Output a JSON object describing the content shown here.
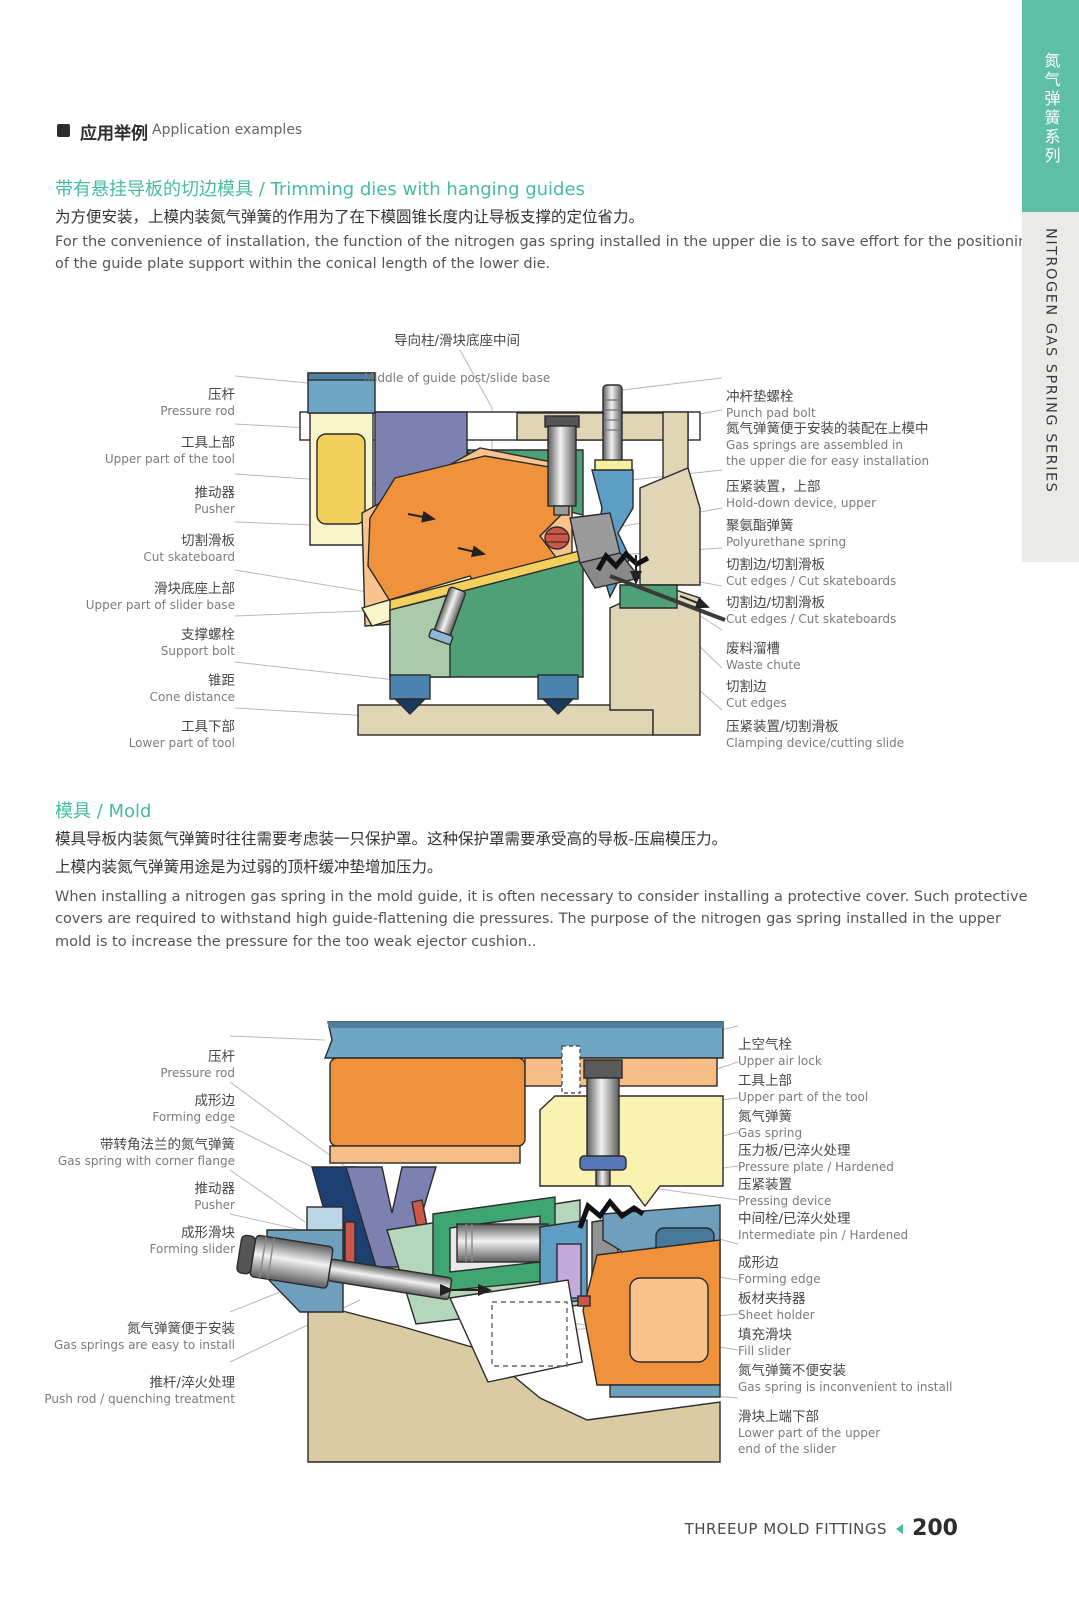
{
  "header": {
    "title_zh": "应用举例",
    "title_en": "Application examples",
    "bullet_icon": "filled-square"
  },
  "sidebar": {
    "title_zh": "氮气弹簧系列",
    "title_en": "NITROGEN GAS SPRING SERIES",
    "teal_color": "#5ebea6",
    "gray_color": "#eaeae8"
  },
  "section1": {
    "heading": "带有悬挂导板的切边模具 / Trimming dies with hanging guides",
    "body_zh": "为方便安装，上模内装氮气弹簧的作用为了在下模圆锥长度内让导板支撑的定位省力。",
    "body_en": "For the convenience of installation, the function of the nitrogen gas spring installed in the upper die is to save effort for the positioning\nof the guide plate support within the conical length of the lower die."
  },
  "diagram1": {
    "top_label": {
      "zh": "导向柱/滑块底座中间",
      "en": "Middle of guide post/slide base"
    },
    "left_labels": [
      {
        "zh": "压杆",
        "en": "Pressure rod"
      },
      {
        "zh": "工具上部",
        "en": "Upper part of the tool"
      },
      {
        "zh": "推动器",
        "en": "Pusher"
      },
      {
        "zh": "切割滑板",
        "en": "Cut skateboard"
      },
      {
        "zh": "滑块底座上部",
        "en": "Upper part of slider base"
      },
      {
        "zh": "支撑螺栓",
        "en": "Support bolt"
      },
      {
        "zh": "锥距",
        "en": "Cone distance"
      },
      {
        "zh": "工具下部",
        "en": "Lower part of tool"
      }
    ],
    "right_labels": [
      {
        "zh": "冲杆垫螺栓",
        "en": "Punch pad bolt"
      },
      {
        "zh": "氮气弹簧便于安装的装配在上模中",
        "en": "Gas springs are assembled in\nthe upper die for easy installation"
      },
      {
        "zh": "压紧装置，上部",
        "en": "Hold-down device, upper"
      },
      {
        "zh": "聚氨酯弹簧",
        "en": "Polyurethane spring"
      },
      {
        "zh": "切割边/切割滑板",
        "en": "Cut edges / Cut skateboards"
      },
      {
        "zh": "切割边/切割滑板",
        "en": "Cut edges / Cut skateboards"
      },
      {
        "zh": "废料溜槽",
        "en": "Waste chute"
      },
      {
        "zh": "切割边",
        "en": "Cut edges"
      },
      {
        "zh": "压紧装置/切割滑板",
        "en": "Clamping device/cutting slide"
      }
    ]
  },
  "section2": {
    "heading": "模具 / Mold",
    "body_zh": "模具导板内装氮气弹簧时往往需要考虑装一只保护罩。这种保护罩需要承受高的导板-压扁模压力。\n上模内装氮气弹簧用途是为过弱的顶杆缓冲垫增加压力。",
    "body_en": "When installing a nitrogen gas spring in the mold guide, it is often necessary to consider installing a protective cover. Such protective\ncovers are required to withstand high guide-flattening die pressures. The purpose of the nitrogen gas spring installed in the upper\nmold is to increase the pressure for the too weak ejector cushion.."
  },
  "diagram2": {
    "left_labels": [
      {
        "zh": "压杆",
        "en": "Pressure rod"
      },
      {
        "zh": "成形边",
        "en": "Forming edge"
      },
      {
        "zh": "带转角法兰的氮气弹簧",
        "en": "Gas spring with corner flange"
      },
      {
        "zh": "推动器",
        "en": "Pusher"
      },
      {
        "zh": "成形滑块",
        "en": "Forming slider"
      },
      {
        "zh": "氮气弹簧便于安装",
        "en": "Gas springs are easy to install"
      },
      {
        "zh": "推杆/淬火处理",
        "en": "Push rod / quenching treatment"
      }
    ],
    "right_labels": [
      {
        "zh": "上空气栓",
        "en": "Upper air lock"
      },
      {
        "zh": "工具上部",
        "en": "Upper part of the tool"
      },
      {
        "zh": "氮气弹簧",
        "en": "Gas spring"
      },
      {
        "zh": "压力板/已淬火处理",
        "en": "Pressure plate / Hardened"
      },
      {
        "zh": "压紧装置",
        "en": "Pressing device"
      },
      {
        "zh": "中间栓/已淬火处理",
        "en": "Intermediate pin / Hardened"
      },
      {
        "zh": "成形边",
        "en": "Forming edge"
      },
      {
        "zh": "板材夹持器",
        "en": "Sheet holder"
      },
      {
        "zh": "填充滑块",
        "en": "Fill slider"
      },
      {
        "zh": "氮气弹簧不便安装",
        "en": "Gas spring is inconvenient to install"
      },
      {
        "zh": "滑块上端下部",
        "en": "Lower part of the upper\nend of the slider"
      }
    ]
  },
  "footer": {
    "brand": "THREEUP MOLD FITTINGS",
    "page_number": "200",
    "arrow_icon": "left-triangle"
  },
  "colors": {
    "accent_teal": "#45bca2",
    "diagram_blue": "#6fa6c6",
    "diagram_orange": "#f0913b",
    "diagram_green": "#4ea077",
    "diagram_yellow": "#f3cf5e",
    "diagram_tan": "#e0d5b5"
  }
}
